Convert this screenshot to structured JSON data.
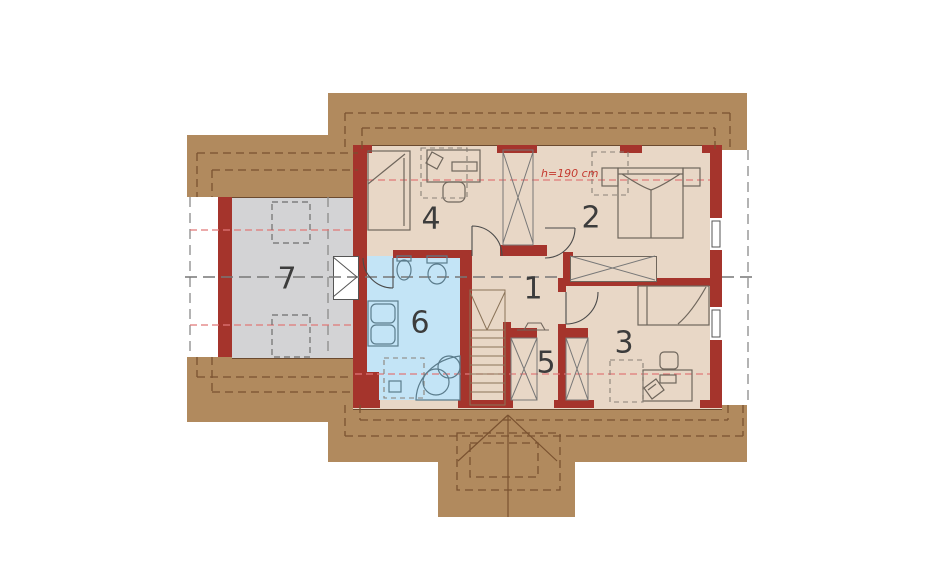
{
  "plan": {
    "type": "architectural-floor-plan-attic-storey",
    "rooms": [
      {
        "number": "1"
      },
      {
        "number": "2"
      },
      {
        "number": "3"
      },
      {
        "number": "4"
      },
      {
        "number": "5"
      },
      {
        "number": "6"
      },
      {
        "number": "7"
      }
    ],
    "annotation": {
      "height_label": "h=190 cm"
    },
    "colors": {
      "roof_band": "#b18a5e",
      "wall_red": "#a5342c",
      "floor_tan": "#e8d7c6",
      "floor_gray": "#d3d3d5",
      "floor_bath_blue": "#c3e4f6",
      "height_line_red": "#e07878",
      "axis_dash_gray": "#777777",
      "roof_dash_brown": "#7a5230"
    }
  }
}
